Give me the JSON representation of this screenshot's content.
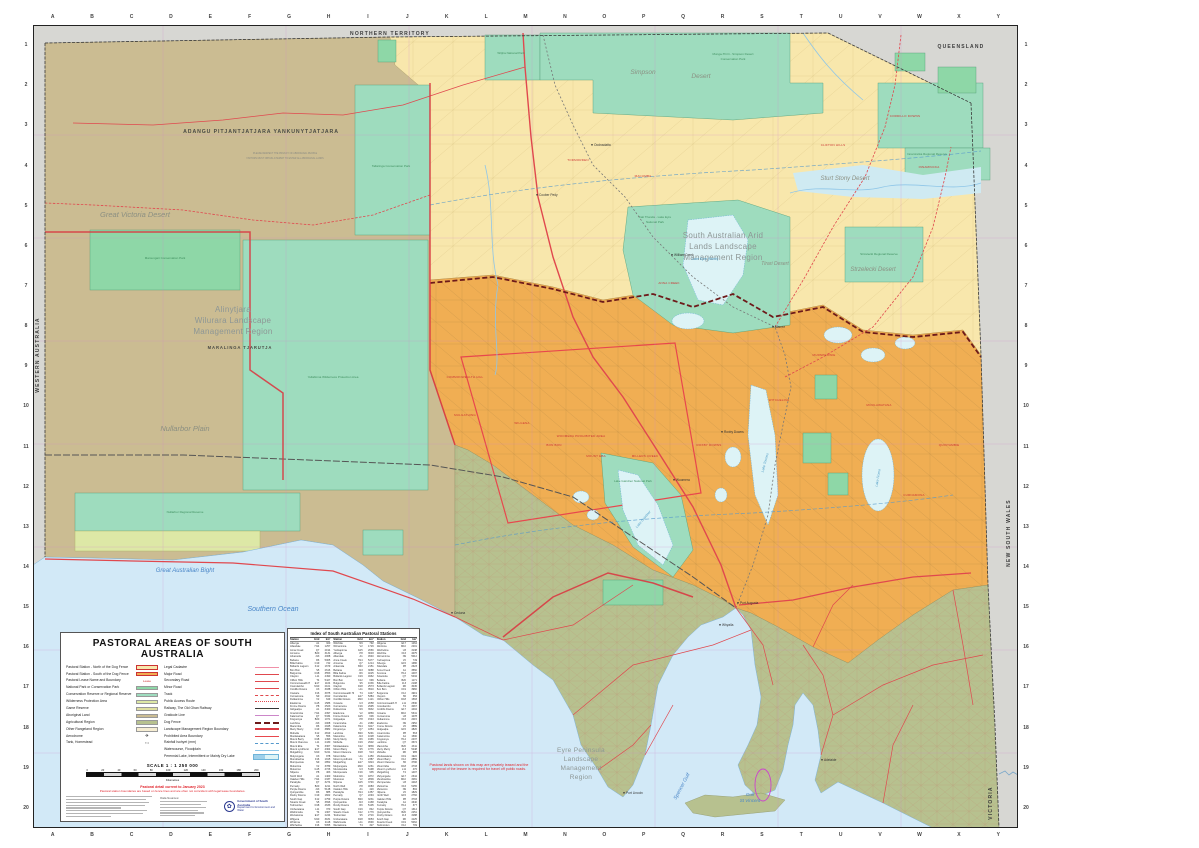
{
  "title": "PASTORAL AREAS OF SOUTH AUSTRALIA",
  "colors": {
    "north_pastoral": "#f8e7ac",
    "south_pastoral": "#f0ae53",
    "aboriginal_land": "#cbbc92",
    "park": "#8ed7a7",
    "reserve": "#9edcbe",
    "wilderness": "#dde8a6",
    "agricultural": "#b7c18f",
    "sea": "#d2e9f7",
    "lake": "#ddf3f6",
    "interstate": "#d7d7d3",
    "dog_fence": "#6d1a1a",
    "road": "#e0484e",
    "region_boundary": "#d93a43"
  },
  "margins": {
    "grid_letters": [
      "A",
      "B",
      "C",
      "D",
      "E",
      "F",
      "G",
      "H",
      "I",
      "J",
      "K",
      "L",
      "M",
      "N",
      "O",
      "P",
      "Q",
      "R",
      "S",
      "T",
      "U",
      "V",
      "W",
      "X",
      "Y"
    ],
    "grid_numbers": [
      "1",
      "2",
      "3",
      "4",
      "5",
      "6",
      "7",
      "8",
      "9",
      "10",
      "11",
      "12",
      "13",
      "14",
      "15",
      "16",
      "17",
      "18",
      "19",
      "20"
    ]
  },
  "legend": {
    "title": "PASTORAL AREAS OF SOUTH AUSTRALIA",
    "left": [
      {
        "label": "Pastoral Station - North of the Dog Fence",
        "sw": "sw-north"
      },
      {
        "label": "Pastoral Station - South of the Dog Fence",
        "sw": "sw-south"
      },
      {
        "label": "Pastoral Lease Name and Boundary",
        "sw": "sw-lease",
        "sample": "Lease"
      },
      {
        "label": "National Park or Conservation Park",
        "sw": "sw-np"
      },
      {
        "label": "Conservation Reserve or Regional Reserve",
        "sw": "sw-cr"
      },
      {
        "label": "Wilderness Protection Area",
        "sw": "sw-wpa"
      },
      {
        "label": "Game Reserve",
        "sw": "sw-game"
      },
      {
        "label": "Aboriginal Land",
        "sw": "sw-ab"
      },
      {
        "label": "Agricultural Region",
        "sw": "sw-ag"
      },
      {
        "label": "Other Rangeland Region",
        "sw": "sw-other"
      },
      {
        "label": "Aerodrome",
        "sw": "sw-aero",
        "sample": "✈"
      },
      {
        "label": "Tank, Homestead",
        "sw": "sw-tank",
        "sample": "▪  •"
      }
    ],
    "right": [
      {
        "label": "Legal Cadastre",
        "sw": "ln-cad"
      },
      {
        "label": "Major Road",
        "sw": "ln-major"
      },
      {
        "label": "Secondary Road",
        "sw": "ln-sec"
      },
      {
        "label": "Minor Road",
        "sw": "ln-minor"
      },
      {
        "label": "Track",
        "sw": "ln-track"
      },
      {
        "label": "Public Access Route",
        "sw": "ln-par"
      },
      {
        "label": "Railway, The Old Ghan Railway",
        "sw": "ln-rail"
      },
      {
        "label": "Graticule Line",
        "sw": "ln-grat"
      },
      {
        "label": "Dog Fence",
        "sw": "ln-dog"
      },
      {
        "label": "Landscape Management Region Boundary",
        "sw": "ln-lmr"
      },
      {
        "label": "Prohibited Area Boundary",
        "sw": "ln-prohib"
      },
      {
        "label": "Rainfall Isohyet (mm)",
        "sw": "ln-iso"
      },
      {
        "label": "Watercourse, Floodplain",
        "sw": "ln-water"
      },
      {
        "label": "Perennial Lake, Intermittent or Mainly Dry Lake",
        "sw": "ln-lake"
      }
    ],
    "scale": {
      "label": "SCALE  1 : 1 250 000",
      "ticks": [
        "0",
        "20",
        "40",
        "60",
        "80",
        "100",
        "120",
        "140",
        "160",
        "180",
        "200"
      ],
      "unit": "Kilometres"
    },
    "notes": [
      "Pastoral detail current to January 2023",
      "Pastoral station boundaries are based on fence lines and are often not coincident with legal lease boundaries."
    ],
    "data_sources_label": "Data Sources:",
    "logo": {
      "line1": "Government of South Australia",
      "line2": "Department for Environment and Water"
    }
  },
  "index_table": {
    "title": "Index of South Australian Pastoral Stations",
    "columns": [
      "Station",
      "Grid",
      "km²"
    ],
    "stations": [
      "Alberga",
      "Allandale",
      "Anna Creek",
      "Arcoona",
      "Arkaroola",
      "Beltana",
      "Billa Kalina",
      "Bollards Lagoon",
      "Bon Bon",
      "Bulgunnia",
      "Clayton",
      "Clifton Hills",
      "Commonwealth Hill",
      "Coondambo",
      "Cordillo Downs",
      "Cowarie",
      "Curnamona",
      "Dulkaninna",
      "Etadunna",
      "Frome Downs",
      "Gidgealpa",
      "Innamincka",
      "Kalamurina",
      "Kingoonya",
      "Lambina",
      "Macumba",
      "Merty Merty",
      "Mobella",
      "Moolawatana",
      "Mount Barry",
      "Mount Clarence",
      "Mount Eba",
      "Mount Lyndhurst",
      "Mulgathing",
      "Mulyungarie",
      "Mundowdna",
      "Murnpeowie",
      "Muloorina",
      "Mutooroo",
      "Nilpena",
      "North Well",
      "Oakden Hills",
      "Parakylia",
      "Pernatty",
      "Purple Downs",
      "Quinyambie",
      "Roxby Downs",
      "South Gap",
      "Stuarts Creek",
      "Todmorden",
      "Umberatana",
      "Wabricoola",
      "Wertaloona",
      "Wilgena",
      "Wintinna",
      "Witchelina",
      "Witchitie",
      "Wirraminna",
      "Yudnapinna"
    ]
  },
  "sea_note": "Pastoral lands shown on this map are privately leased and the approval of the lessee is required for travel off public roads.",
  "map_labels": [
    {
      "t": "NORTHERN TERRITORY",
      "x": 357,
      "y": 10,
      "cls": "t-state"
    },
    {
      "t": "QUEENSLAND",
      "x": 928,
      "y": 23,
      "cls": "t-state"
    },
    {
      "t": "WESTERN AUSTRALIA",
      "x": 6,
      "y": 330,
      "cls": "t-state",
      "r": -90
    },
    {
      "t": "NEW SOUTH WALES",
      "x": 977,
      "y": 508,
      "cls": "t-state",
      "r": -90
    },
    {
      "t": "VICTORIA",
      "x": 959,
      "y": 778,
      "cls": "t-state",
      "r": -90
    },
    {
      "t": "AŊANGU PITJANTJATJARA YANKUNYTJATJARA",
      "x": 228,
      "y": 108,
      "cls": "t-aborig",
      "fs": 5.2
    },
    {
      "t": "PLEASE RESPECT THE PRIVACY OF ABORIGINAL PEOPLE",
      "x": 252,
      "y": 129,
      "cls": "t-micro"
    },
    {
      "t": "VISITORS MUST OBTAIN A PERMIT TO ENTER ALL ABORIGINAL LANDS",
      "x": 252,
      "y": 134,
      "cls": "t-micro"
    },
    {
      "t": "MARALINGA TJARUTJA",
      "x": 207,
      "y": 324,
      "cls": "t-aborig",
      "fs": 4.2
    },
    {
      "t": "Great Victoria Desert",
      "x": 102,
      "y": 192,
      "cls": "t-desert",
      "fs": 7.5
    },
    {
      "t": "Nullarbor Plain",
      "x": 152,
      "y": 406,
      "cls": "t-desert",
      "fs": 7.5
    },
    {
      "t": "Simpson",
      "x": 610,
      "y": 49,
      "cls": "t-desert",
      "fs": 6.5
    },
    {
      "t": "Desert",
      "x": 668,
      "y": 53,
      "cls": "t-desert",
      "fs": 6.5
    },
    {
      "t": "Sturt Stony Desert",
      "x": 812,
      "y": 155,
      "cls": "t-desert",
      "fs": 6
    },
    {
      "t": "Strzelecki Desert",
      "x": 840,
      "y": 246,
      "cls": "t-desert",
      "fs": 6
    },
    {
      "t": "Tirari Desert",
      "x": 742,
      "y": 240,
      "cls": "t-desert",
      "fs": 5
    },
    {
      "t": "Alinytjara",
      "x": 200,
      "y": 287,
      "cls": "t-region",
      "fs": 8
    },
    {
      "t": "Wilurara Landscape",
      "x": 200,
      "y": 298,
      "cls": "t-region",
      "fs": 8
    },
    {
      "t": "Management Region",
      "x": 200,
      "y": 309,
      "cls": "t-region",
      "fs": 8
    },
    {
      "t": "South Australian Arid",
      "x": 690,
      "y": 213,
      "cls": "t-region",
      "fs": 8
    },
    {
      "t": "Lands Landscape",
      "x": 690,
      "y": 224,
      "cls": "t-region",
      "fs": 8
    },
    {
      "t": "Management Region",
      "x": 690,
      "y": 235,
      "cls": "t-region",
      "fs": 8
    },
    {
      "t": "Eyre Peninsula",
      "x": 548,
      "y": 727,
      "cls": "t-region",
      "fs": 6.5
    },
    {
      "t": "Landscape",
      "x": 548,
      "y": 736,
      "cls": "t-region",
      "fs": 6.5
    },
    {
      "t": "Management",
      "x": 548,
      "y": 745,
      "cls": "t-region",
      "fs": 6.5
    },
    {
      "t": "Region",
      "x": 548,
      "y": 754,
      "cls": "t-region",
      "fs": 6.5
    },
    {
      "t": "Great Australian Bight",
      "x": 152,
      "y": 547,
      "cls": "t-water",
      "fs": 6
    },
    {
      "t": "Southern Ocean",
      "x": 240,
      "y": 586,
      "cls": "t-water",
      "fs": 7
    },
    {
      "t": "Spencer Gulf",
      "x": 650,
      "y": 762,
      "cls": "t-water",
      "fs": 5,
      "r": -62
    },
    {
      "t": "Gulf",
      "x": 717,
      "y": 771,
      "cls": "t-water",
      "fs": 4.5
    },
    {
      "t": "St Vincent",
      "x": 717,
      "y": 777,
      "cls": "t-water",
      "fs": 4.5
    },
    {
      "t": "Lake Eyre (North)",
      "x": 672,
      "y": 235,
      "cls": "t-waterS",
      "fs": 3.4
    },
    {
      "t": "Lake Torrens",
      "x": 733,
      "y": 438,
      "cls": "t-waterS",
      "fs": 3.4,
      "r": -75
    },
    {
      "t": "Lake Gairdner",
      "x": 611,
      "y": 495,
      "cls": "t-waterS",
      "fs": 3.4,
      "r": -50
    },
    {
      "t": "Lake Frome",
      "x": 846,
      "y": 453,
      "cls": "t-waterS",
      "fs": 3.4,
      "r": -80
    },
    {
      "t": "Munga-Thirri - Simpson Desert",
      "x": 700,
      "y": 30,
      "cls": "t-park"
    },
    {
      "t": "Conservation Park",
      "x": 700,
      "y": 35,
      "cls": "t-park"
    },
    {
      "t": "Kati Thanda - Lake Eyre",
      "x": 622,
      "y": 193,
      "cls": "t-park"
    },
    {
      "t": "National Park",
      "x": 622,
      "y": 198,
      "cls": "t-park"
    },
    {
      "t": "Tallaringa Conservation Park",
      "x": 358,
      "y": 142,
      "cls": "t-park"
    },
    {
      "t": "Mamungari Conservation Park",
      "x": 132,
      "y": 234,
      "cls": "t-park"
    },
    {
      "t": "Yellabinna Wilderness Protection Area",
      "x": 300,
      "y": 353,
      "cls": "t-park"
    },
    {
      "t": "Nullarbor Regional Reserve",
      "x": 152,
      "y": 488,
      "cls": "t-park"
    },
    {
      "t": "Innamincka Regional Reserve",
      "x": 894,
      "y": 130,
      "cls": "t-park"
    },
    {
      "t": "Strzelecki Regional Reserve",
      "x": 846,
      "y": 230,
      "cls": "t-park"
    },
    {
      "t": "Lake Gairdner National Park",
      "x": 600,
      "y": 457,
      "cls": "t-park"
    },
    {
      "t": "Witjira National Park",
      "x": 478,
      "y": 29,
      "cls": "t-park"
    },
    {
      "t": "WOOMERA PROHIBITED AREA",
      "x": 548,
      "y": 412,
      "cls": "t-stn"
    }
  ],
  "station_labels": [
    {
      "t": "TODMORDEN",
      "x": 545,
      "y": 136
    },
    {
      "t": "MACUMBA",
      "x": 610,
      "y": 152
    },
    {
      "t": "ANNA CREEK",
      "x": 636,
      "y": 259
    },
    {
      "t": "COMMONWEALTH HILL",
      "x": 432,
      "y": 353
    },
    {
      "t": "MULGATHING",
      "x": 432,
      "y": 391
    },
    {
      "t": "WILGENA",
      "x": 489,
      "y": 399
    },
    {
      "t": "BON BON",
      "x": 521,
      "y": 421
    },
    {
      "t": "MOUNT EBA",
      "x": 563,
      "y": 432
    },
    {
      "t": "MILLERS CREEK",
      "x": 612,
      "y": 432
    },
    {
      "t": "ROXBY DOWNS",
      "x": 676,
      "y": 421
    },
    {
      "t": "MURNPEOWIE",
      "x": 791,
      "y": 331
    },
    {
      "t": "CORDILLO DOWNS",
      "x": 872,
      "y": 92
    },
    {
      "t": "CLIFTON HILLS",
      "x": 800,
      "y": 121
    },
    {
      "t": "INNAMINCKA",
      "x": 896,
      "y": 143
    },
    {
      "t": "CURNAMONA",
      "x": 881,
      "y": 471
    },
    {
      "t": "QUINYAMBIE",
      "x": 916,
      "y": 421
    },
    {
      "t": "WITCHELINA",
      "x": 746,
      "y": 376
    },
    {
      "t": "MOOLAWATANA",
      "x": 846,
      "y": 381
    }
  ],
  "towns": [
    {
      "t": "Oodnadatta",
      "x": 561,
      "y": 121
    },
    {
      "t": "Coober Pedy",
      "x": 506,
      "y": 171
    },
    {
      "t": "Marree",
      "x": 742,
      "y": 303
    },
    {
      "t": "William Creek",
      "x": 641,
      "y": 231
    },
    {
      "t": "Roxby Downs",
      "x": 691,
      "y": 408
    },
    {
      "t": "Woomera",
      "x": 643,
      "y": 456
    },
    {
      "t": "Port Augusta",
      "x": 707,
      "y": 579
    },
    {
      "t": "Whyalla",
      "x": 689,
      "y": 601
    },
    {
      "t": "Port Lincoln",
      "x": 593,
      "y": 769
    },
    {
      "t": "Ceduna",
      "x": 421,
      "y": 589
    },
    {
      "t": "Adelaide",
      "x": 791,
      "y": 736
    }
  ]
}
